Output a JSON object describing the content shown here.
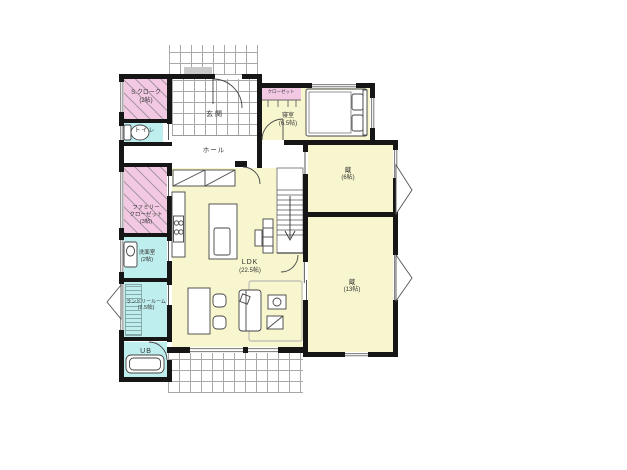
{
  "title": "1F間取り図",
  "rooms": {
    "s_cloak": {
      "name": "S.クローク",
      "size": "(2帖)"
    },
    "toilet": {
      "name": "トイレ"
    },
    "entrance": {
      "name": "玄関"
    },
    "hall": {
      "name": "ホール"
    },
    "bedroom": {
      "name": "寝室",
      "size": "(6.5帖)"
    },
    "bedroom_closet": {
      "name": "クローゼット"
    },
    "kura_upper": {
      "name": "蔵",
      "size": "(6帖)"
    },
    "kura_lower": {
      "name": "蔵",
      "size": "(13帖)"
    },
    "ldk": {
      "name": "LDK",
      "size": "(22.5帖)"
    },
    "family_closet": {
      "name1": "ファミリー",
      "name2": "クローゼット",
      "size": "(3帖)"
    },
    "washroom": {
      "name": "洗面室",
      "size": "(2帖)"
    },
    "laundry": {
      "name": "ランドリールーム",
      "size": "(2.5帖)"
    },
    "unit_bath": {
      "name": "UB"
    }
  },
  "colors": {
    "room-yellow": "#f8f6cf",
    "room-pink": "#f2c8e2",
    "room-cyan": "#bfeeee",
    "wall": "#161616",
    "grid-line": "#a8a8a8",
    "label-color": "#333333"
  }
}
